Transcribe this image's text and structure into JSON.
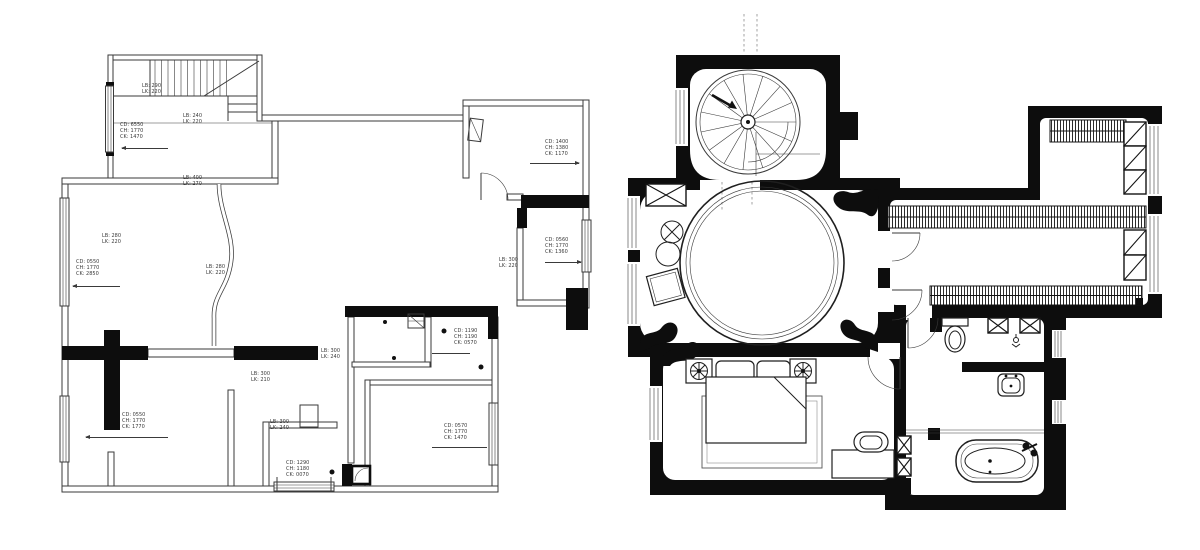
{
  "page": {
    "background": "#ffffff",
    "line_color": "#3a3a3a",
    "wall_color": "#0d0d0d"
  },
  "plans": {
    "left": {
      "name": "dimension-floor-plan",
      "symbols": [
        "staircase",
        "curved-partition",
        "door-swing",
        "windows",
        "power-outlet",
        "shower-unit",
        "floor-drain"
      ],
      "annotations": [
        {
          "x": 142,
          "y": 84,
          "lines": [
            "LB: 290",
            "LK: 220"
          ]
        },
        {
          "x": 183,
          "y": 114,
          "lines": [
            "LB: 240",
            "LK: 220"
          ]
        },
        {
          "x": 120,
          "y": 123,
          "lines": [
            "CD: 6550",
            "CH: 1770",
            "CK: 1470"
          ],
          "arrow": {
            "x1": 122,
            "x2": 168,
            "y": 148,
            "head": "left"
          }
        },
        {
          "x": 183,
          "y": 176,
          "lines": [
            "LB: 400",
            "LK: 270"
          ]
        },
        {
          "x": 102,
          "y": 234,
          "lines": [
            "LB: 280",
            "LK: 220"
          ]
        },
        {
          "x": 76,
          "y": 260,
          "lines": [
            "CD: 0550",
            "CH: 1770",
            "CK: 2850"
          ],
          "arrow": {
            "x1": 73,
            "x2": 120,
            "y": 286,
            "head": "left"
          }
        },
        {
          "x": 206,
          "y": 265,
          "lines": [
            "LB: 280",
            "LK: 220"
          ]
        },
        {
          "x": 545,
          "y": 140,
          "lines": [
            "CD: 1400",
            "CH: 1380",
            "CK: 1170"
          ],
          "arrow": {
            "x1": 530,
            "x2": 579,
            "y": 163,
            "head": "right"
          }
        },
        {
          "x": 545,
          "y": 238,
          "lines": [
            "CD: 0560",
            "CH: 1770",
            "CK: 1360"
          ],
          "arrow": {
            "x1": 545,
            "x2": 581,
            "y": 262,
            "head": "right"
          }
        },
        {
          "x": 499,
          "y": 258,
          "lines": [
            "LB: 300",
            "LK: 220"
          ]
        },
        {
          "x": 251,
          "y": 372,
          "lines": [
            "LB: 300",
            "LK: 210"
          ]
        },
        {
          "x": 321,
          "y": 349,
          "lines": [
            "LB: 300",
            "LK: 240"
          ]
        },
        {
          "x": 270,
          "y": 420,
          "lines": [
            "LB: 300",
            "LK: 240"
          ]
        },
        {
          "x": 122,
          "y": 413,
          "lines": [
            "CD: 0550",
            "CH: 1770",
            "CK: 1770"
          ],
          "arrow": {
            "x1": 86,
            "x2": 168,
            "y": 437,
            "head": "left"
          }
        },
        {
          "x": 286,
          "y": 461,
          "lines": [
            "CD: 1290",
            "CH: 1180",
            "CK: 0070"
          ]
        },
        {
          "x": 454,
          "y": 329,
          "lines": [
            "CD: 1190",
            "CH: 1190",
            "CK: 0570"
          ],
          "arrow": {
            "x1": 432,
            "x2": 470,
            "y": 353,
            "head": "none"
          }
        },
        {
          "x": 444,
          "y": 424,
          "lines": [
            "CD: 0570",
            "CH: 1770",
            "CK: 1470"
          ],
          "arrow": {
            "x1": 432,
            "x2": 487,
            "y": 447,
            "head": "none"
          }
        }
      ]
    },
    "right": {
      "name": "furnished-floor-plan",
      "symbols": [
        "spiral-staircase",
        "circular-platform",
        "potted-plant",
        "side-table",
        "ottoman",
        "double-bed",
        "pillows",
        "area-rug",
        "bedside-fixtures",
        "desk",
        "chair",
        "wardrobe-hatching",
        "shelving-boxes",
        "toilet",
        "wash-basin",
        "bathtub",
        "door-swings",
        "windows",
        "structural-columns"
      ]
    }
  }
}
